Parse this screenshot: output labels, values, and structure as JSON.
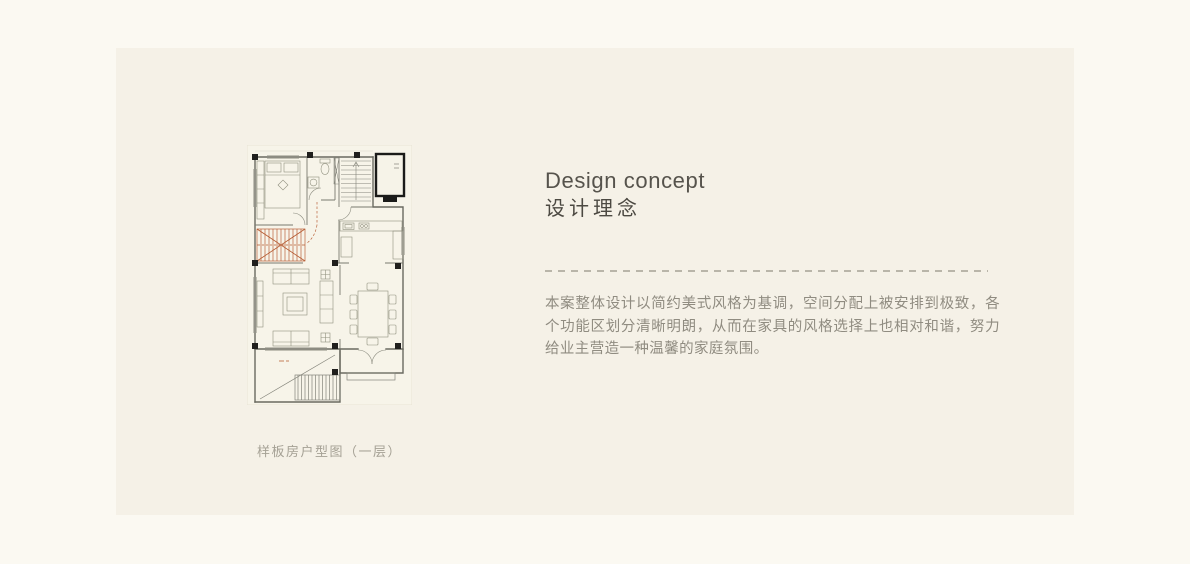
{
  "page": {
    "background": "#fbf9f2",
    "panel_background": "#f5f1e7"
  },
  "section": {
    "title_en": "Design concept",
    "title_cn": "设计理念",
    "body": "本案整体设计以简约美式风格为基调，空间分配上被安排到极致，各个功能区划分清晰明朗，从而在家具的风格选择上也相对和谐，努力给业主营造一种温馨的家庭氛围。"
  },
  "figure": {
    "caption": "样板房户型图（一层）",
    "type": "floor-plan",
    "floor": "一层",
    "accent_color": "#b5582e"
  },
  "colors": {
    "title": "#56534c",
    "title_cn": "#4c4942",
    "body_text": "#908c81",
    "caption": "#a5a195",
    "divider_dash": "#b9b5a9",
    "plan_line": "#6a6a60",
    "plan_column": "#201f1d",
    "plan_paper": "#f7f4e9",
    "stair_accent": "#b5582e"
  }
}
